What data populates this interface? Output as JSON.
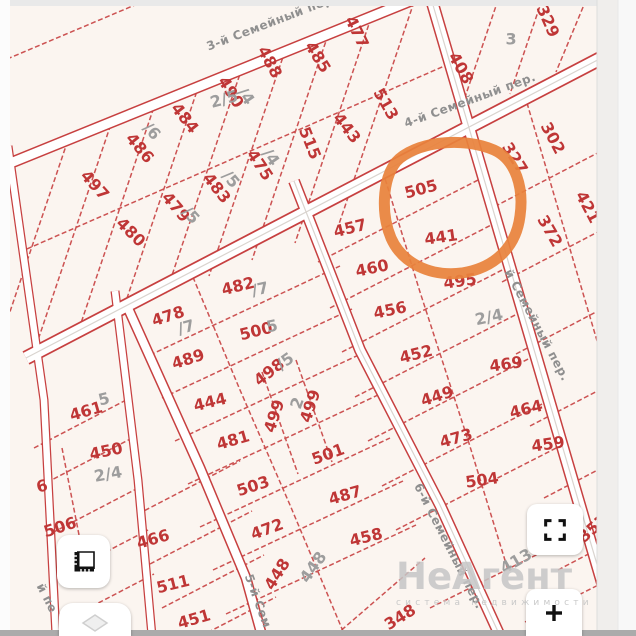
{
  "map": {
    "background": "#fbf5f0",
    "line_color": "#c74040",
    "label_color": "#bf3636",
    "muted_label_color": "#9d9d9d",
    "highlight": {
      "parcels": [
        "505",
        "441"
      ],
      "color": "#e8823c"
    },
    "parcels": [
      {
        "label": "497",
        "x": 95,
        "y": 185,
        "rot": 48
      },
      {
        "label": "486",
        "x": 140,
        "y": 148,
        "rot": 50
      },
      {
        "label": "484",
        "x": 185,
        "y": 118,
        "rot": 52
      },
      {
        "label": "490",
        "x": 231,
        "y": 92,
        "rot": 58
      },
      {
        "label": "488",
        "x": 270,
        "y": 62,
        "rot": 62
      },
      {
        "label": "485",
        "x": 318,
        "y": 57,
        "rot": 58
      },
      {
        "label": "477",
        "x": 357,
        "y": 32,
        "rot": 64
      },
      {
        "label": "480",
        "x": 131,
        "y": 232,
        "rot": 45
      },
      {
        "label": "479",
        "x": 176,
        "y": 207,
        "rot": 50
      },
      {
        "label": "483",
        "x": 217,
        "y": 188,
        "rot": 52
      },
      {
        "label": "475",
        "x": 260,
        "y": 165,
        "rot": 56
      },
      {
        "label": "515",
        "x": 310,
        "y": 143,
        "rot": 68
      },
      {
        "label": "443",
        "x": 347,
        "y": 128,
        "rot": 52
      },
      {
        "label": "513",
        "x": 386,
        "y": 104,
        "rot": 60
      },
      {
        "label": "408",
        "x": 461,
        "y": 68,
        "rot": 60
      },
      {
        "label": "329",
        "x": 548,
        "y": 21,
        "rot": 66
      },
      {
        "label": "302",
        "x": 553,
        "y": 138,
        "rot": 62
      },
      {
        "label": "327",
        "x": 515,
        "y": 158,
        "rot": 58
      },
      {
        "label": "421",
        "x": 588,
        "y": 207,
        "rot": 62,
        "size": 15
      },
      {
        "label": "372",
        "x": 550,
        "y": 231,
        "rot": 60
      },
      {
        "label": "505",
        "x": 421,
        "y": 189,
        "rot": -15,
        "size": 18
      },
      {
        "label": "441",
        "x": 441,
        "y": 237,
        "rot": -8,
        "size": 18
      },
      {
        "label": "457",
        "x": 350,
        "y": 228,
        "rot": -14
      },
      {
        "label": "460",
        "x": 372,
        "y": 268,
        "rot": -12
      },
      {
        "label": "495",
        "x": 460,
        "y": 281,
        "rot": -8
      },
      {
        "label": "456",
        "x": 390,
        "y": 310,
        "rot": -12
      },
      {
        "label": "452",
        "x": 416,
        "y": 354,
        "rot": -14
      },
      {
        "label": "469",
        "x": 506,
        "y": 364,
        "rot": -8
      },
      {
        "label": "449",
        "x": 437,
        "y": 396,
        "rot": -18
      },
      {
        "label": "464",
        "x": 526,
        "y": 409,
        "rot": -14
      },
      {
        "label": "473",
        "x": 456,
        "y": 438,
        "rot": -16
      },
      {
        "label": "459",
        "x": 548,
        "y": 444,
        "rot": -8
      },
      {
        "label": "504",
        "x": 482,
        "y": 480,
        "rot": -8
      },
      {
        "label": "357",
        "x": 593,
        "y": 528,
        "rot": -42,
        "size": 15
      },
      {
        "label": "348",
        "x": 400,
        "y": 617,
        "rot": -32
      },
      {
        "label": "478",
        "x": 168,
        "y": 316,
        "rot": -18
      },
      {
        "label": "482",
        "x": 238,
        "y": 286,
        "rot": -14
      },
      {
        "label": "500",
        "x": 256,
        "y": 331,
        "rot": -14
      },
      {
        "label": "489",
        "x": 188,
        "y": 359,
        "rot": -18
      },
      {
        "label": "498",
        "x": 269,
        "y": 372,
        "rot": -38
      },
      {
        "label": "444",
        "x": 210,
        "y": 402,
        "rot": -14
      },
      {
        "label": "499",
        "x": 274,
        "y": 416,
        "rot": -72,
        "size": 14
      },
      {
        "label": "499",
        "x": 310,
        "y": 406,
        "rot": -72,
        "size": 14
      },
      {
        "label": "481",
        "x": 233,
        "y": 440,
        "rot": -16
      },
      {
        "label": "503",
        "x": 253,
        "y": 486,
        "rot": -18
      },
      {
        "label": "501",
        "x": 328,
        "y": 454,
        "rot": -20
      },
      {
        "label": "472",
        "x": 267,
        "y": 529,
        "rot": -20
      },
      {
        "label": "487",
        "x": 345,
        "y": 495,
        "rot": -16
      },
      {
        "label": "458",
        "x": 366,
        "y": 537,
        "rot": -14
      },
      {
        "label": "448",
        "x": 277,
        "y": 574,
        "rot": -58
      },
      {
        "label": "466",
        "x": 153,
        "y": 539,
        "rot": -16
      },
      {
        "label": "506",
        "x": 60,
        "y": 527,
        "rot": -18
      },
      {
        "label": "511",
        "x": 173,
        "y": 584,
        "rot": -14
      },
      {
        "label": "451",
        "x": 194,
        "y": 619,
        "rot": -16
      },
      {
        "label": "461",
        "x": 86,
        "y": 411,
        "rot": -16
      },
      {
        "label": "450",
        "x": 106,
        "y": 451,
        "rot": -12
      },
      {
        "label": "6",
        "x": 42,
        "y": 486,
        "rot": -15,
        "size": 14
      },
      {
        "label": "2/5",
        "x": 224,
        "y": 99,
        "rot": -15,
        "color": "g",
        "size": 13
      },
      {
        "label": "3",
        "x": 511,
        "y": 39,
        "rot": 0,
        "color": "g",
        "size": 14
      },
      {
        "label": "2/4",
        "x": 489,
        "y": 317,
        "rot": -12,
        "color": "g",
        "size": 14
      },
      {
        "label": "2/4",
        "x": 108,
        "y": 474,
        "rot": -10,
        "color": "g",
        "size": 13
      },
      {
        "label": "/7",
        "x": 186,
        "y": 327,
        "rot": -16,
        "color": "g",
        "size": 12
      },
      {
        "label": "/7",
        "x": 260,
        "y": 289,
        "rot": -12,
        "color": "g",
        "size": 12
      },
      {
        "label": "/6",
        "x": 152,
        "y": 131,
        "rot": 48,
        "color": "g",
        "size": 12
      },
      {
        "label": "/4",
        "x": 246,
        "y": 96,
        "rot": 55,
        "color": "g",
        "size": 12
      },
      {
        "label": "/5",
        "x": 231,
        "y": 179,
        "rot": 50,
        "color": "g",
        "size": 12
      },
      {
        "label": "/4",
        "x": 271,
        "y": 157,
        "rot": 55,
        "color": "g",
        "size": 12
      },
      {
        "label": "/5",
        "x": 191,
        "y": 215,
        "rot": 48,
        "color": "g",
        "size": 12
      },
      {
        "label": "/5",
        "x": 285,
        "y": 361,
        "rot": -35,
        "color": "g",
        "size": 12
      },
      {
        "label": "5",
        "x": 104,
        "y": 399,
        "rot": -14,
        "color": "g",
        "size": 11
      },
      {
        "label": "5",
        "x": 272,
        "y": 326,
        "rot": -12,
        "color": "g",
        "size": 11
      },
      {
        "label": "2",
        "x": 297,
        "y": 403,
        "rot": -70,
        "color": "g",
        "size": 11
      },
      {
        "label": "448",
        "x": 313,
        "y": 567,
        "rot": -55,
        "color": "g",
        "size": 13
      },
      {
        "label": "413",
        "x": 516,
        "y": 561,
        "rot": -30,
        "color": "g",
        "size": 14
      }
    ],
    "streets": [
      {
        "name": "3-й Семейный пер.",
        "x": 272,
        "y": 22,
        "rot": -21
      },
      {
        "name": "4-й Семейный пер.",
        "x": 470,
        "y": 100,
        "rot": -20
      },
      {
        "name": "й Семейный пер.",
        "x": 537,
        "y": 325,
        "rot": 62
      },
      {
        "name": "6-й Семейный пер.",
        "x": 449,
        "y": 546,
        "rot": 63
      },
      {
        "name": "5-й Сем",
        "x": 258,
        "y": 601,
        "rot": 70
      },
      {
        "name": "й пе",
        "x": 47,
        "y": 598,
        "rot": 63
      }
    ]
  },
  "controls": {
    "measure_tool": "ruler",
    "layers_tool": "layers",
    "fullscreen_tool": "fullscreen",
    "zoom_in_tool": "zoom-in"
  },
  "watermark": {
    "title": "НеАгент",
    "subtitle": "система недвижимости"
  }
}
